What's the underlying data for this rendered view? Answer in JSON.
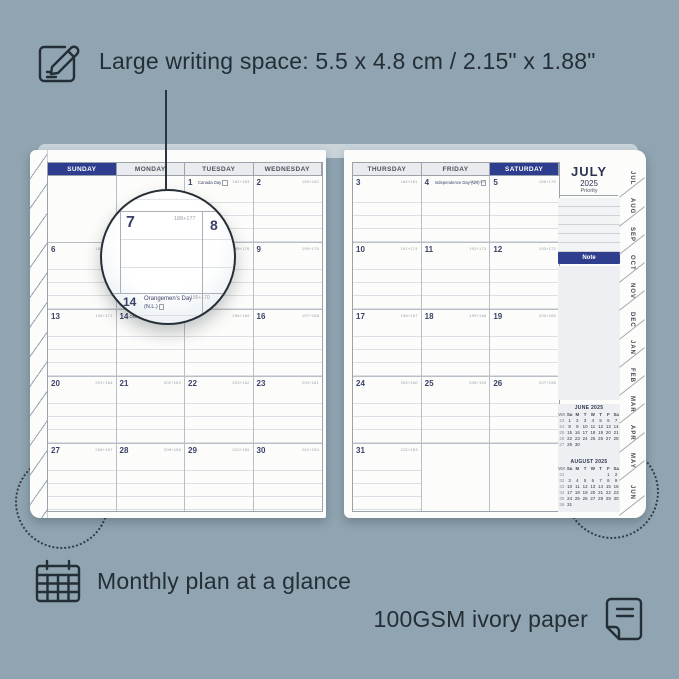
{
  "colors": {
    "background": "#90a5b1",
    "ink": "#242e36",
    "accent_navy": "#2e3d8e",
    "page": "#fcfcfa",
    "header_gray": "#e9ebee"
  },
  "top_callout": {
    "icon": "pencil-note-icon",
    "text": "Large writing space: 5.5 x 4.8 cm / 2.15\" x 1.88\""
  },
  "bottom_callouts": [
    {
      "icon": "calendar-grid-icon",
      "text": "Monthly plan at a glance"
    },
    {
      "icon": "paper-icon",
      "text": "100GSM ivory paper"
    }
  ],
  "planner": {
    "left_page": {
      "headers": [
        {
          "label": "SUNDAY",
          "accent": true
        },
        {
          "label": "MONDAY",
          "accent": false
        },
        {
          "label": "TUESDAY",
          "accent": false
        },
        {
          "label": "WEDNESDAY",
          "accent": false
        }
      ],
      "weeks": [
        [
          {},
          {},
          {
            "day": "1",
            "code": "182+183",
            "holiday": "Canada Day",
            "hicon": true
          },
          {
            "day": "2",
            "code": "183+182"
          }
        ],
        [
          {
            "day": "6",
            "code": "187+178"
          },
          {
            "day": "7",
            "code": "188+177"
          },
          {
            "day": "8",
            "code": "189+176"
          },
          {
            "day": "9",
            "code": "190+175"
          }
        ],
        [
          {
            "day": "13",
            "code": "194+171"
          },
          {
            "day": "14",
            "code": "195+170",
            "holiday": "Orangemen's Day (N.L.)",
            "hicon": true
          },
          {
            "day": "15",
            "code": "196+169"
          },
          {
            "day": "16",
            "code": "197+168"
          }
        ],
        [
          {
            "day": "20",
            "code": "201+164"
          },
          {
            "day": "21",
            "code": "202+163"
          },
          {
            "day": "22",
            "code": "203+162"
          },
          {
            "day": "23",
            "code": "204+161"
          }
        ],
        [
          {
            "day": "27",
            "code": "208+157"
          },
          {
            "day": "28",
            "code": "209+156"
          },
          {
            "day": "29",
            "code": "210+155"
          },
          {
            "day": "30",
            "code": "211+154"
          }
        ]
      ]
    },
    "right_page": {
      "headers": [
        {
          "label": "THURSDAY",
          "accent": false
        },
        {
          "label": "FRIDAY",
          "accent": false
        },
        {
          "label": "SATURDAY",
          "accent": true
        }
      ],
      "weeks": [
        [
          {
            "day": "3",
            "code": "184+181"
          },
          {
            "day": "4",
            "code": "185+180",
            "holiday": "Independence Day (US)",
            "hicon": true
          },
          {
            "day": "5",
            "code": "186+179"
          }
        ],
        [
          {
            "day": "10",
            "code": "191+174"
          },
          {
            "day": "11",
            "code": "192+173"
          },
          {
            "day": "12",
            "code": "193+172"
          }
        ],
        [
          {
            "day": "17",
            "code": "198+167"
          },
          {
            "day": "18",
            "code": "199+166"
          },
          {
            "day": "19",
            "code": "200+165"
          }
        ],
        [
          {
            "day": "24",
            "code": "205+160"
          },
          {
            "day": "25",
            "code": "206+159"
          },
          {
            "day": "26",
            "code": "207+158"
          }
        ],
        [
          {
            "day": "31",
            "code": "212+153"
          },
          {},
          {}
        ]
      ]
    },
    "sidebar": {
      "month": "JULY",
      "year": "2025",
      "priority_label": "Priority",
      "note_label": "Note",
      "mini_months": [
        {
          "title": "JUNE 2025",
          "cols": [
            "WK",
            "Su",
            "M",
            "T",
            "W",
            "T",
            "F",
            "Sa"
          ],
          "rows": [
            [
              "23",
              "1",
              "2",
              "3",
              "4",
              "5",
              "6",
              "7"
            ],
            [
              "24",
              "8",
              "9",
              "10",
              "11",
              "12",
              "13",
              "14"
            ],
            [
              "25",
              "15",
              "16",
              "17",
              "18",
              "19",
              "20",
              "21"
            ],
            [
              "26",
              "22",
              "23",
              "24",
              "25",
              "26",
              "27",
              "28"
            ],
            [
              "27",
              "29",
              "30",
              "",
              "",
              "",
              "",
              ""
            ]
          ]
        },
        {
          "title": "AUGUST 2025",
          "cols": [
            "WK",
            "Su",
            "M",
            "T",
            "W",
            "T",
            "F",
            "Sa"
          ],
          "rows": [
            [
              "31",
              "",
              "",
              "",
              "",
              "",
              "1",
              "2"
            ],
            [
              "32",
              "3",
              "4",
              "5",
              "6",
              "7",
              "8",
              "9"
            ],
            [
              "33",
              "10",
              "11",
              "12",
              "13",
              "14",
              "15",
              "16"
            ],
            [
              "34",
              "17",
              "18",
              "19",
              "20",
              "21",
              "22",
              "23"
            ],
            [
              "35",
              "24",
              "25",
              "26",
              "27",
              "28",
              "29",
              "30"
            ],
            [
              "36",
              "31",
              "",
              "",
              "",
              "",
              "",
              ""
            ]
          ]
        }
      ]
    },
    "month_tabs": [
      "JUL",
      "AUG",
      "SEP",
      "OCT",
      "NOV",
      "DEC",
      "JAN",
      "FEB",
      "MAR",
      "APR",
      "MAY",
      "JUN"
    ]
  },
  "magnifier": {
    "day_a": "7",
    "code_a": "188+177",
    "day_b": "8",
    "day_c": "14",
    "holiday_c": "Orangemen's Day",
    "holiday_c_sub": "(N.L.)",
    "code_c": "195+170"
  }
}
